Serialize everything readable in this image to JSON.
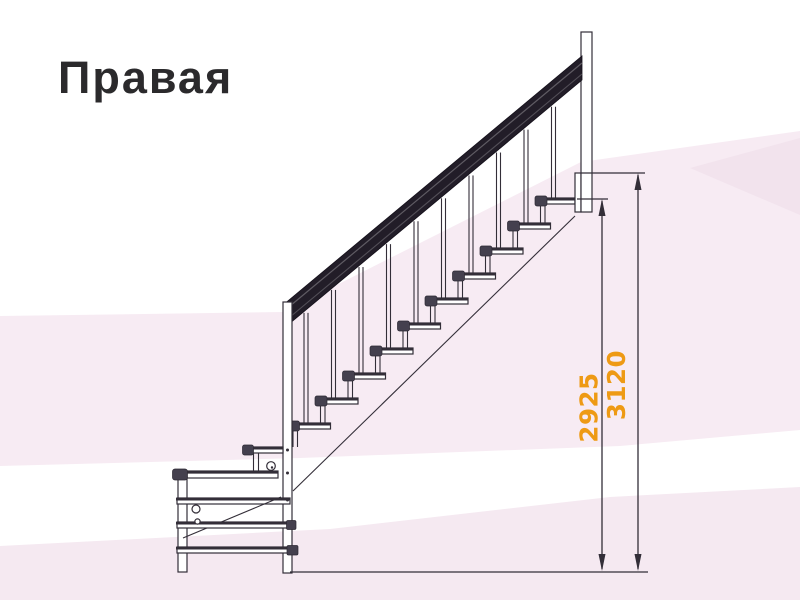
{
  "page": {
    "title": "Правая"
  },
  "drawing": {
    "dimension_labels": [
      {
        "id": "height-to-top-tread",
        "label": "2925"
      },
      {
        "id": "height-to-landing",
        "label": "3120"
      }
    ]
  },
  "colors": {
    "accent_orange": "#ee9a14",
    "ink": "#332e38",
    "background_tint_light": "#f7ebf3",
    "background_tint_lower": "#f5e9f1"
  }
}
